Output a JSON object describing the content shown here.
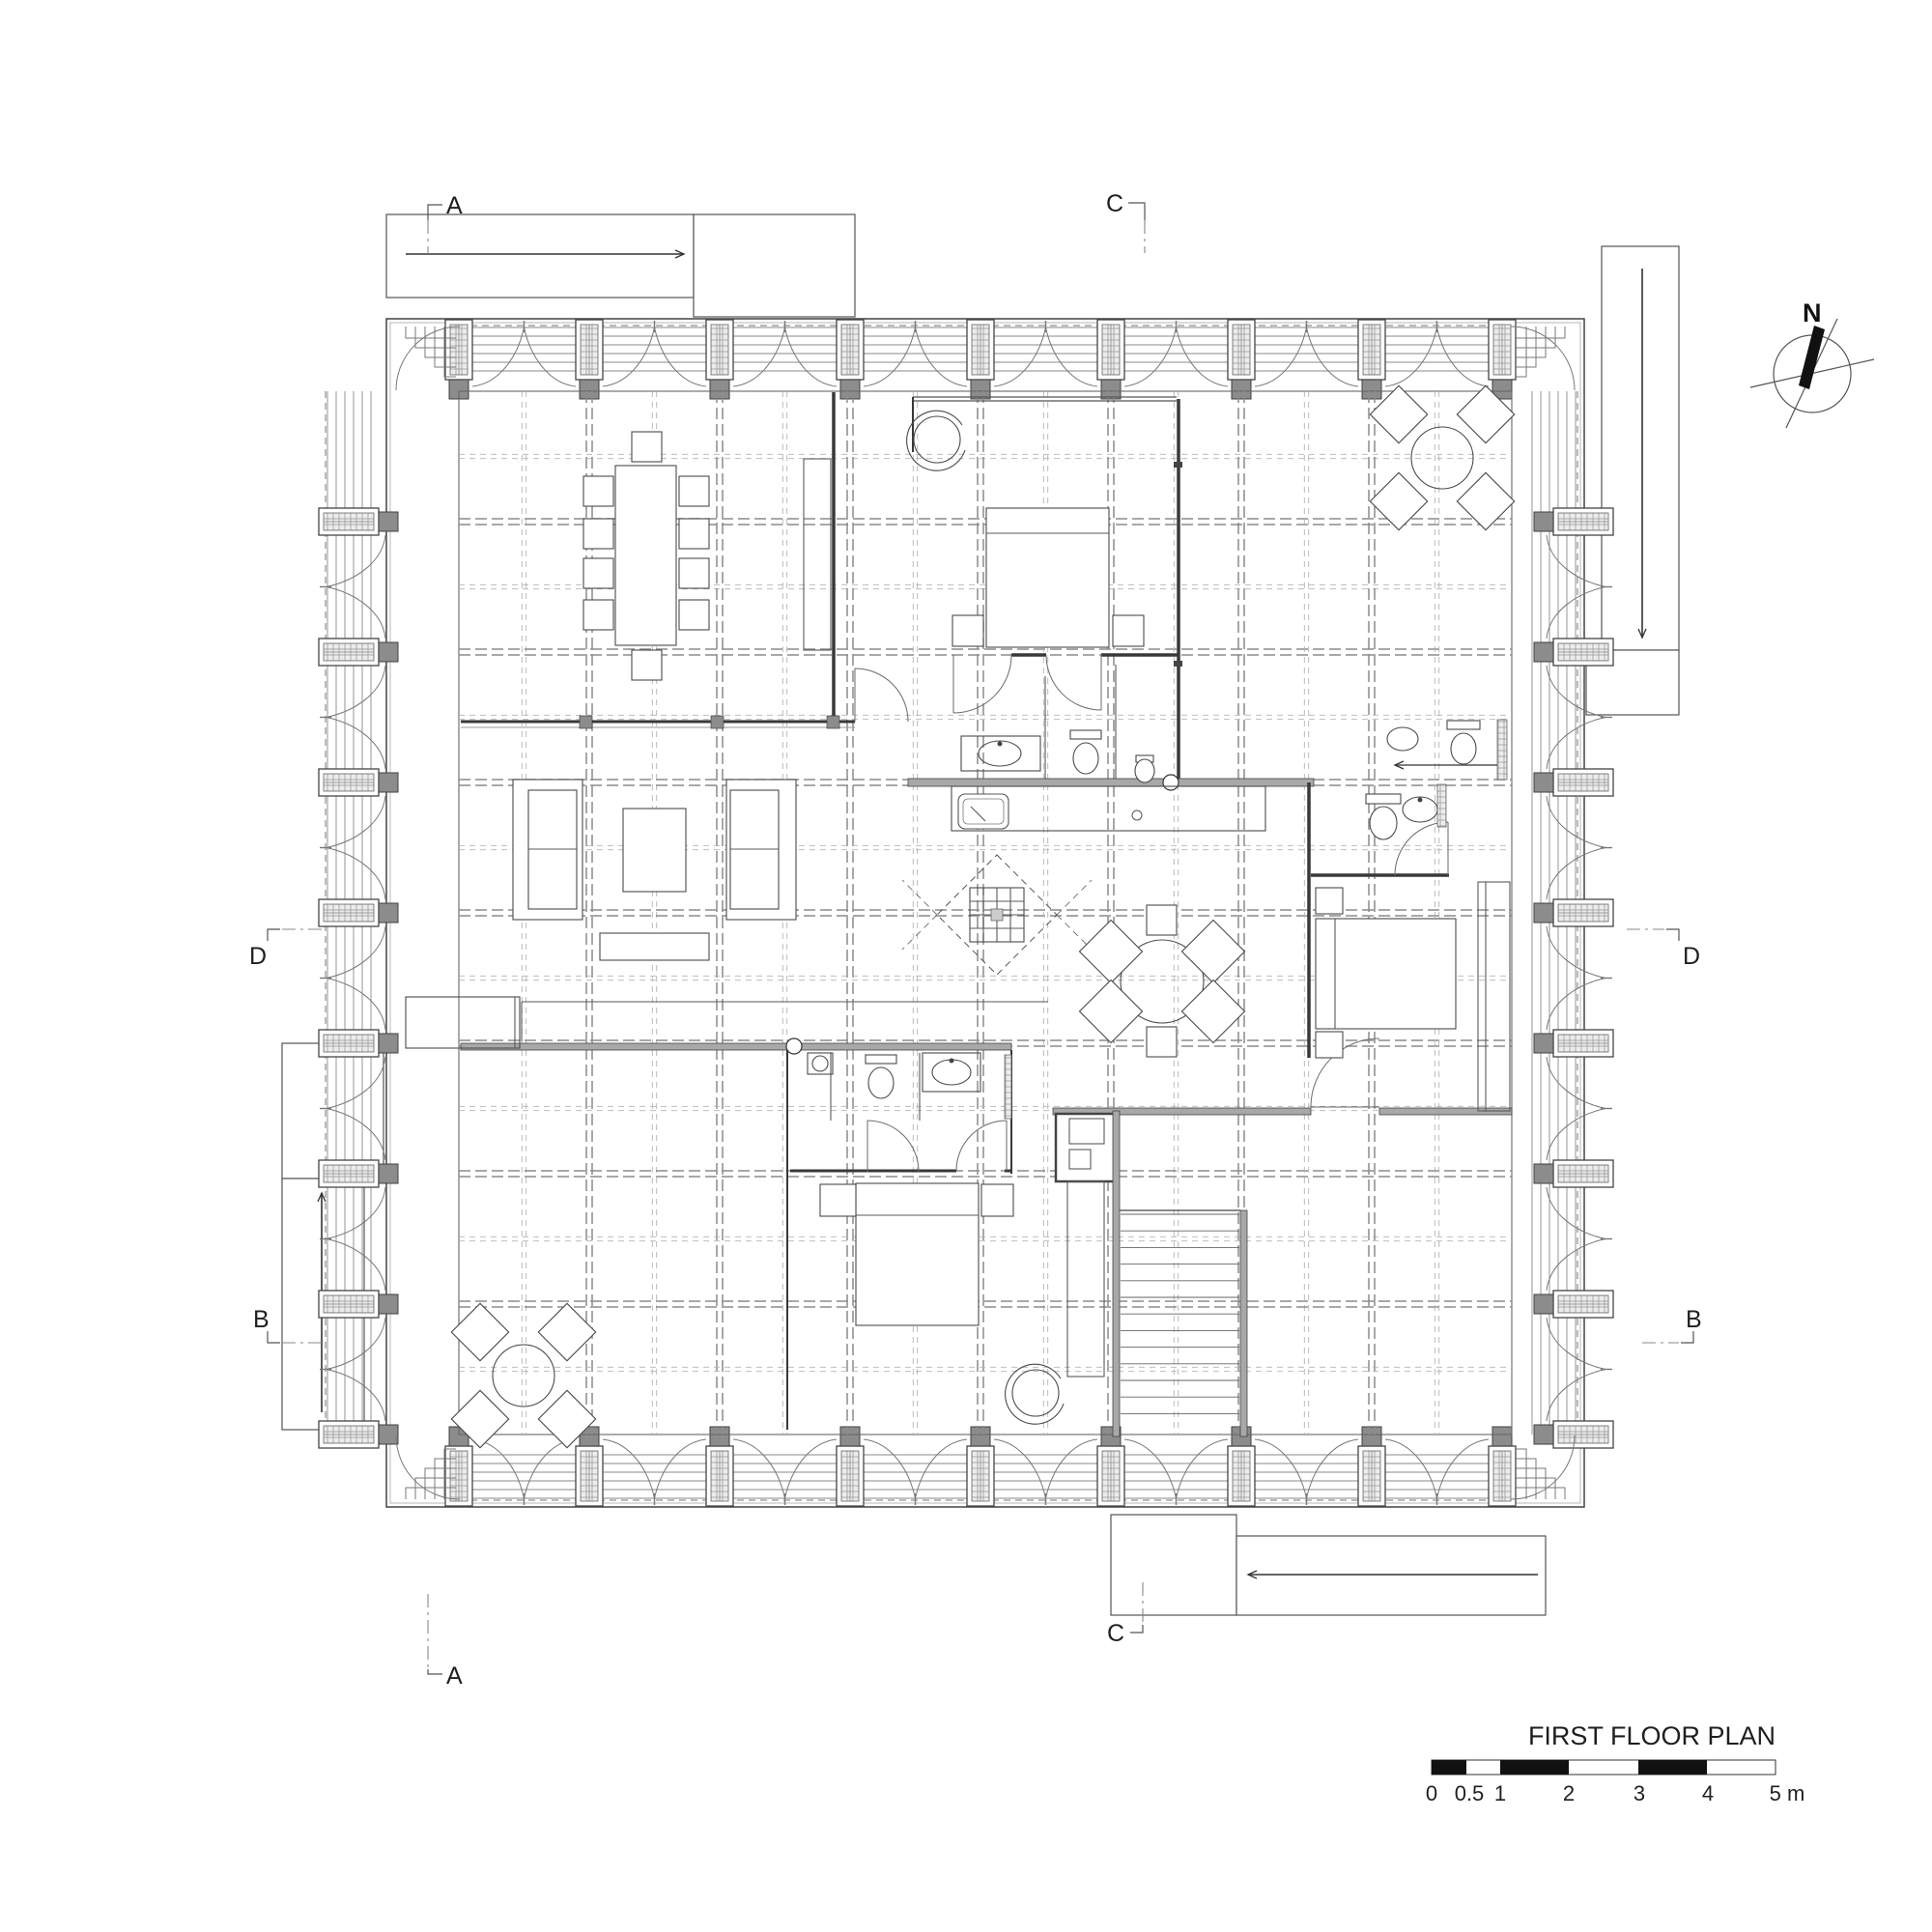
{
  "sheet": {
    "title": "FIRST FLOOR PLAN",
    "compass_label": "N",
    "ink_color": "#2f2f2f",
    "wall_fill_color": "#a8a8a8"
  },
  "section_markers": {
    "a_top": "A",
    "a_bottom": "A",
    "b_left": "B",
    "b_right": "B",
    "c_top": "C",
    "c_bottom": "C",
    "d_left": "D",
    "d_right": "D"
  },
  "scale_bar": {
    "labels": [
      "0",
      "0.5",
      "1",
      "2",
      "3",
      "4",
      "5 m"
    ]
  }
}
